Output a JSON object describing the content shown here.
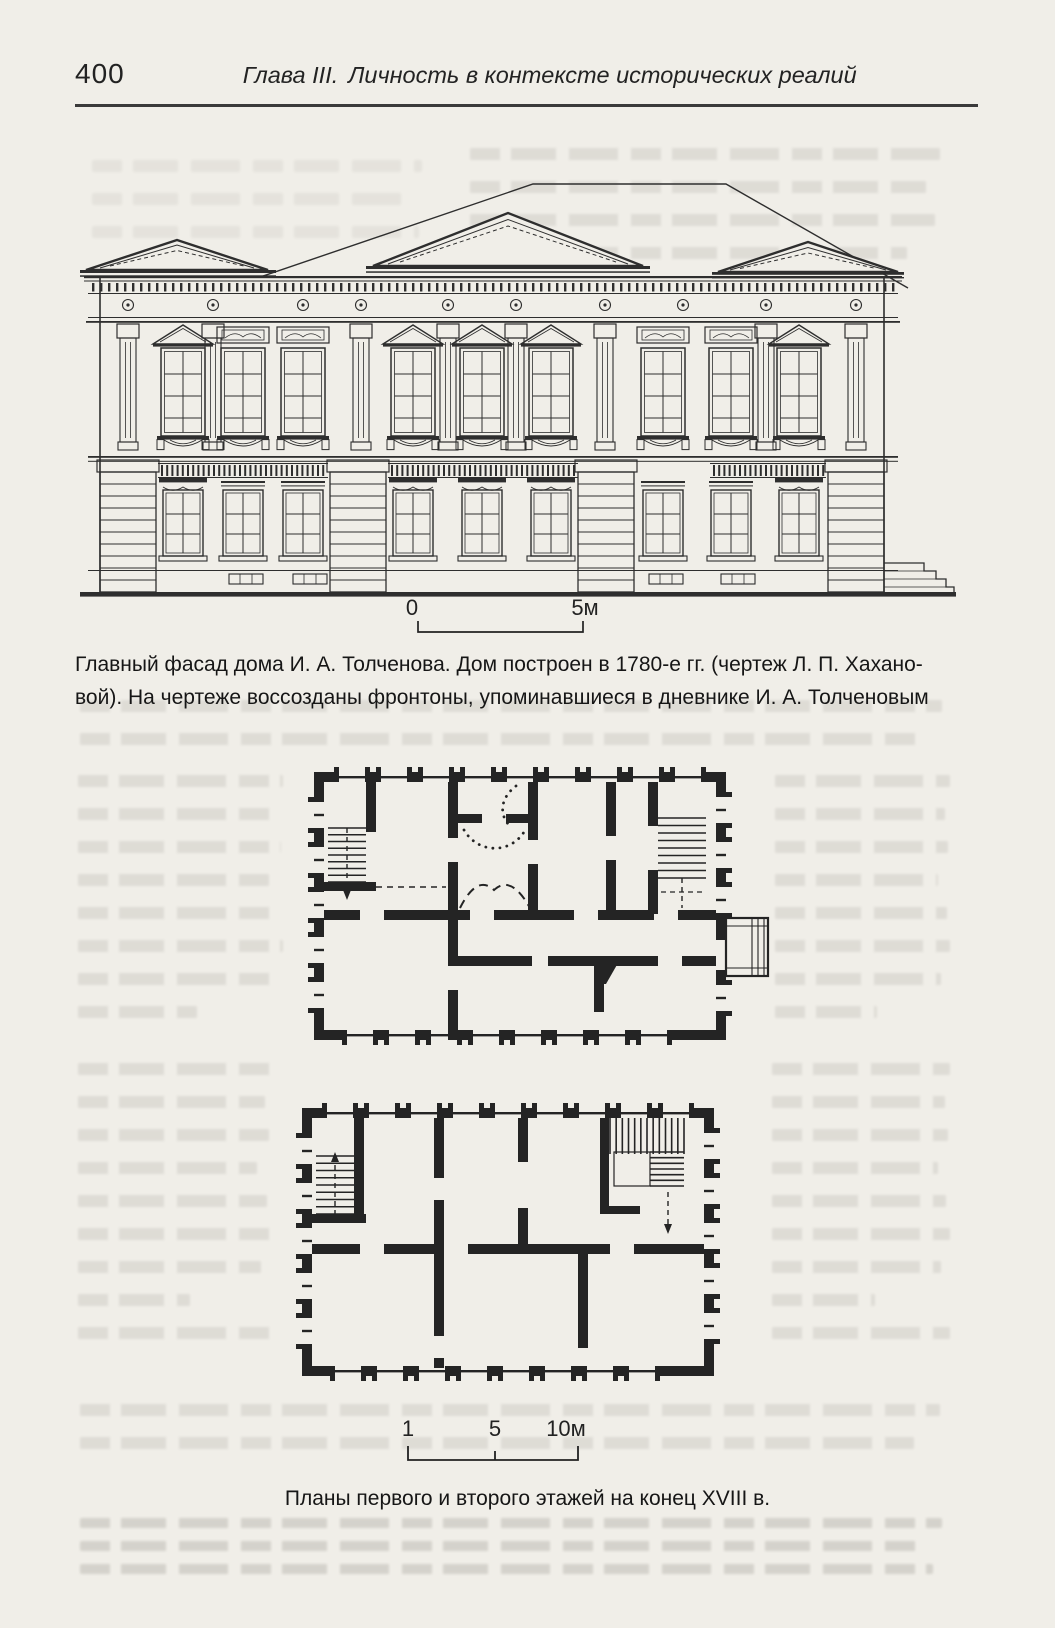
{
  "page": {
    "number": "400",
    "chapter_label": "Глава III.",
    "chapter_title": "Личность в контексте исторических реалий"
  },
  "figure_facade": {
    "caption_line1": "Главный фасад дома И. А. Толченова. Дом построен в 1780-е гг. (чертеж Л. П. Хахано-",
    "caption_line2": "вой). На чертеже воссозданы фронтоны, упоминавшиеся в дневнике И. А. Толченовым",
    "scale": {
      "zero": "0",
      "five": "5м"
    }
  },
  "figure_plans": {
    "caption": "Планы первого и второго этажей на конец XVIII в.",
    "scale": {
      "one": "1",
      "five": "5",
      "ten": "10м"
    }
  },
  "colors": {
    "paper": "#f0eee8",
    "ink": "#2e2e2e",
    "plan_ink": "#242424"
  }
}
